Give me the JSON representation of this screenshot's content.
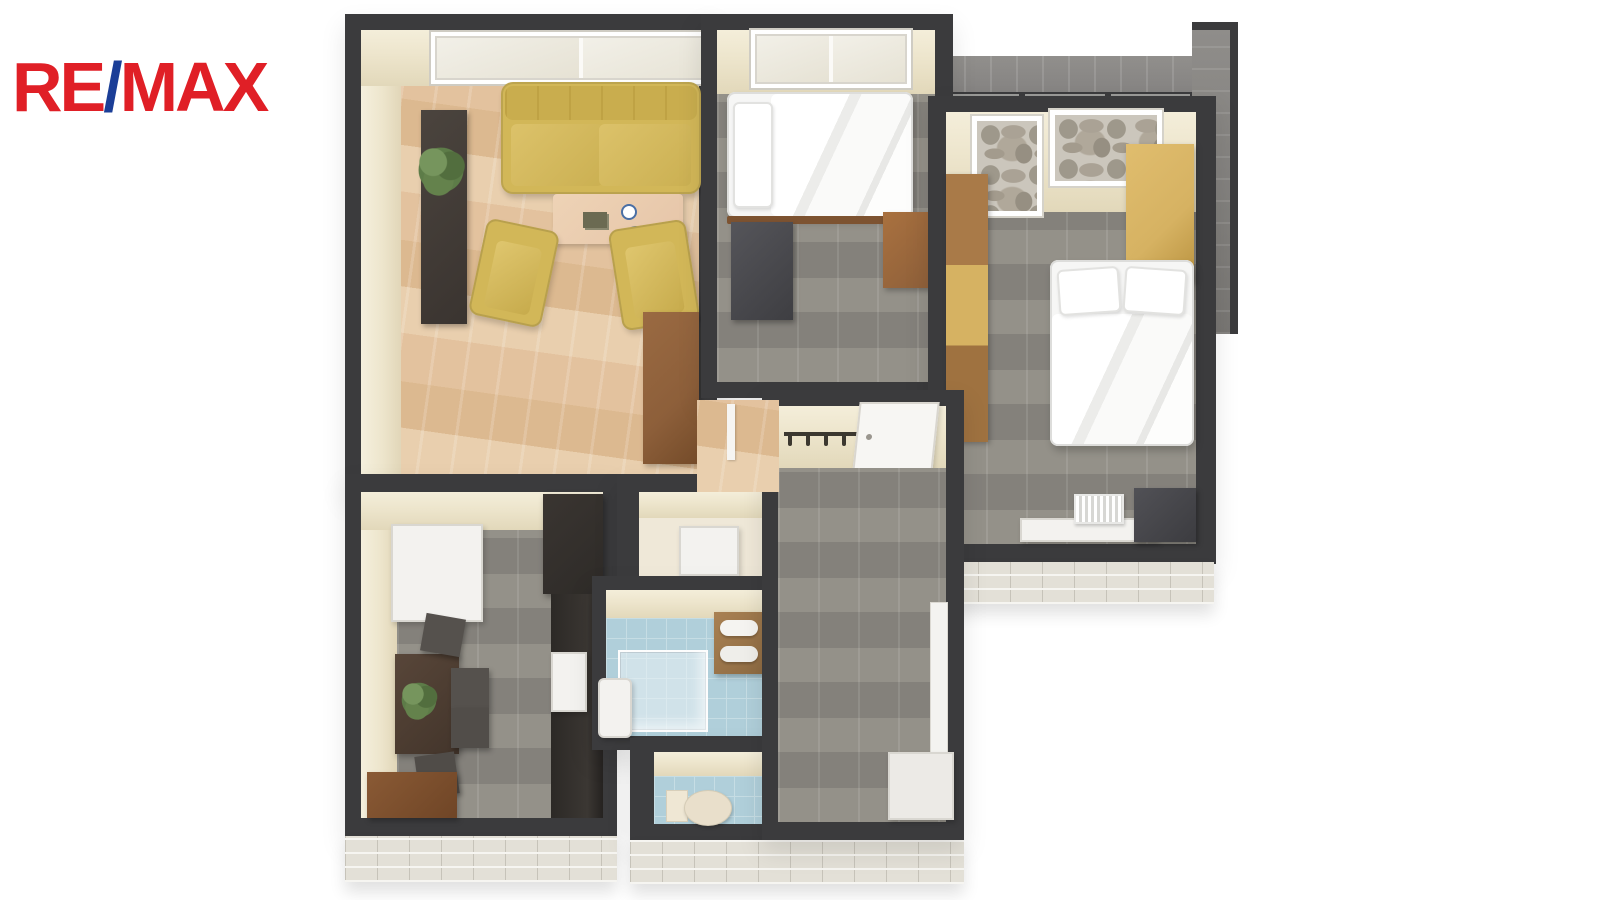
{
  "logo": {
    "part_re": "RE",
    "part_slash": "/",
    "part_max": "MAX"
  },
  "palette": {
    "logo_red": "#e01f26",
    "logo_blue": "#1b3e97",
    "wall": "#3b3b3d",
    "wall_face": "#ede5cc",
    "wood_floor_a": "#e9cfae",
    "wood_floor_b": "#dcb990",
    "gray_floor_a": "#949189",
    "gray_floor_b": "#84817b",
    "tile_blue_a": "#b0cfda",
    "tile_blue_b": "#c6dde4",
    "brick_a": "#e3e0d7",
    "brick_b": "#f6f5f1",
    "sofa_yellow": "#d2b758",
    "sofa_yellow_dark": "#bfa244",
    "furniture_brown": "#8d5f3a",
    "furniture_dark": "#47453f",
    "wardrobe_tan": "#d6b262",
    "table_wood": "#e6c5a8",
    "white_goods": "#f3f2ef",
    "bed_white": "#f6f6f5",
    "plant_green": "#5d7c48",
    "kitchen_dark": "#2e2b28"
  },
  "scene": {
    "type": "3d-floor-plan-render",
    "rooms": [
      "living-room",
      "bedroom-small",
      "bedroom-main",
      "kitchen-dining",
      "closet",
      "bathroom",
      "wc",
      "hallway",
      "balcony"
    ],
    "furniture": [
      "sofa",
      "armchair",
      "armchair",
      "coffee-table",
      "sideboard",
      "plant",
      "bookshelf",
      "single-bed",
      "tv-stand",
      "desk",
      "double-bed",
      "wardrobe",
      "radiator",
      "cabinet",
      "fridge",
      "kitchen-unit",
      "dishwasher",
      "dining-table",
      "dining-chairs",
      "lower-cabinet",
      "washer",
      "shower",
      "sink",
      "towel-cabinet",
      "toilet",
      "coat-rack",
      "entry-door",
      "shoe-cabinet"
    ]
  }
}
